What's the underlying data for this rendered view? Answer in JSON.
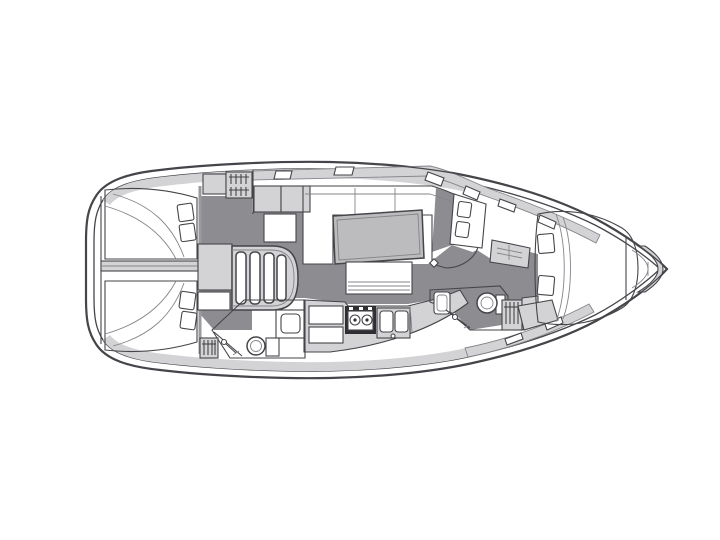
{
  "figure": {
    "kind": "sailing-yacht-interior-floor-plan",
    "orientation": "bow-right"
  },
  "palette": {
    "background": "#ffffff",
    "white": "#ffffff",
    "outline": "#45454a",
    "line_soft": "#85858a",
    "deck": "#d3d3d5",
    "floor": "#8d8d91",
    "table": "#bcbcbe",
    "dark_unit": "#2f2f33"
  },
  "icons": {
    "hanging-locker": "hanger-stripes",
    "stove": "two-burner-cooker",
    "sink": "double-basin",
    "toilet": "bowl-with-tank",
    "shower": "sprayer-with-hose",
    "companionway": "four-curved-steps",
    "anchor-locker": "bow-crescents"
  }
}
